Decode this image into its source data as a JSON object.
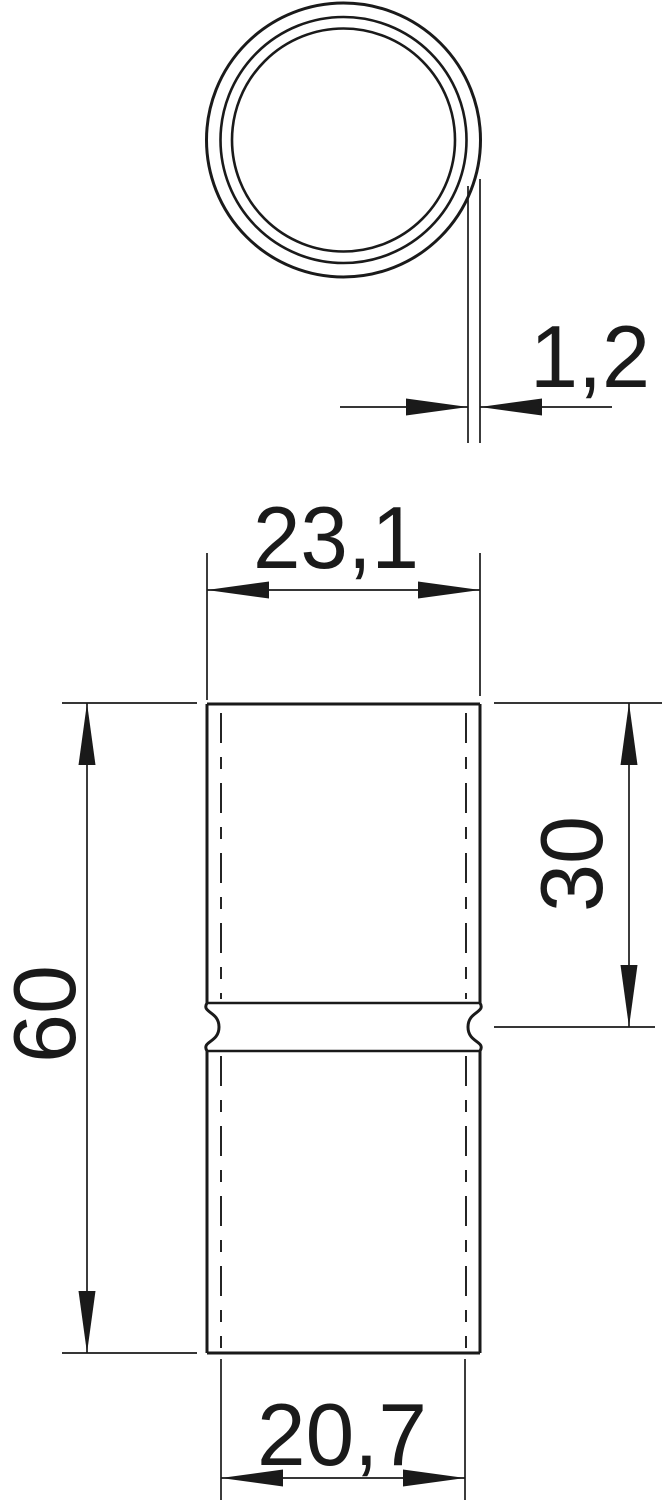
{
  "drawing": {
    "title": "Tube sleeve coupler dimension drawing",
    "type": "technical-dimension-drawing",
    "units": "mm",
    "decimal_separator": ",",
    "colors": {
      "line": "#1a1a1a",
      "background": "#ffffff"
    },
    "views": {
      "top_view": "cross-section with three concentric circles and wall-thickness callout",
      "front_view": "cylindrical sleeve with center waist groove, hidden bore shown as dash-dot lines"
    },
    "dimensions": {
      "wall_thickness": {
        "label": "1,2",
        "orientation": "horizontal"
      },
      "outer_diameter": {
        "label": "23,1",
        "orientation": "horizontal"
      },
      "insert_depth": {
        "label": "30",
        "orientation": "vertical"
      },
      "total_length": {
        "label": "60",
        "orientation": "vertical"
      },
      "inner_diameter": {
        "label": "20,7",
        "orientation": "horizontal"
      }
    }
  }
}
